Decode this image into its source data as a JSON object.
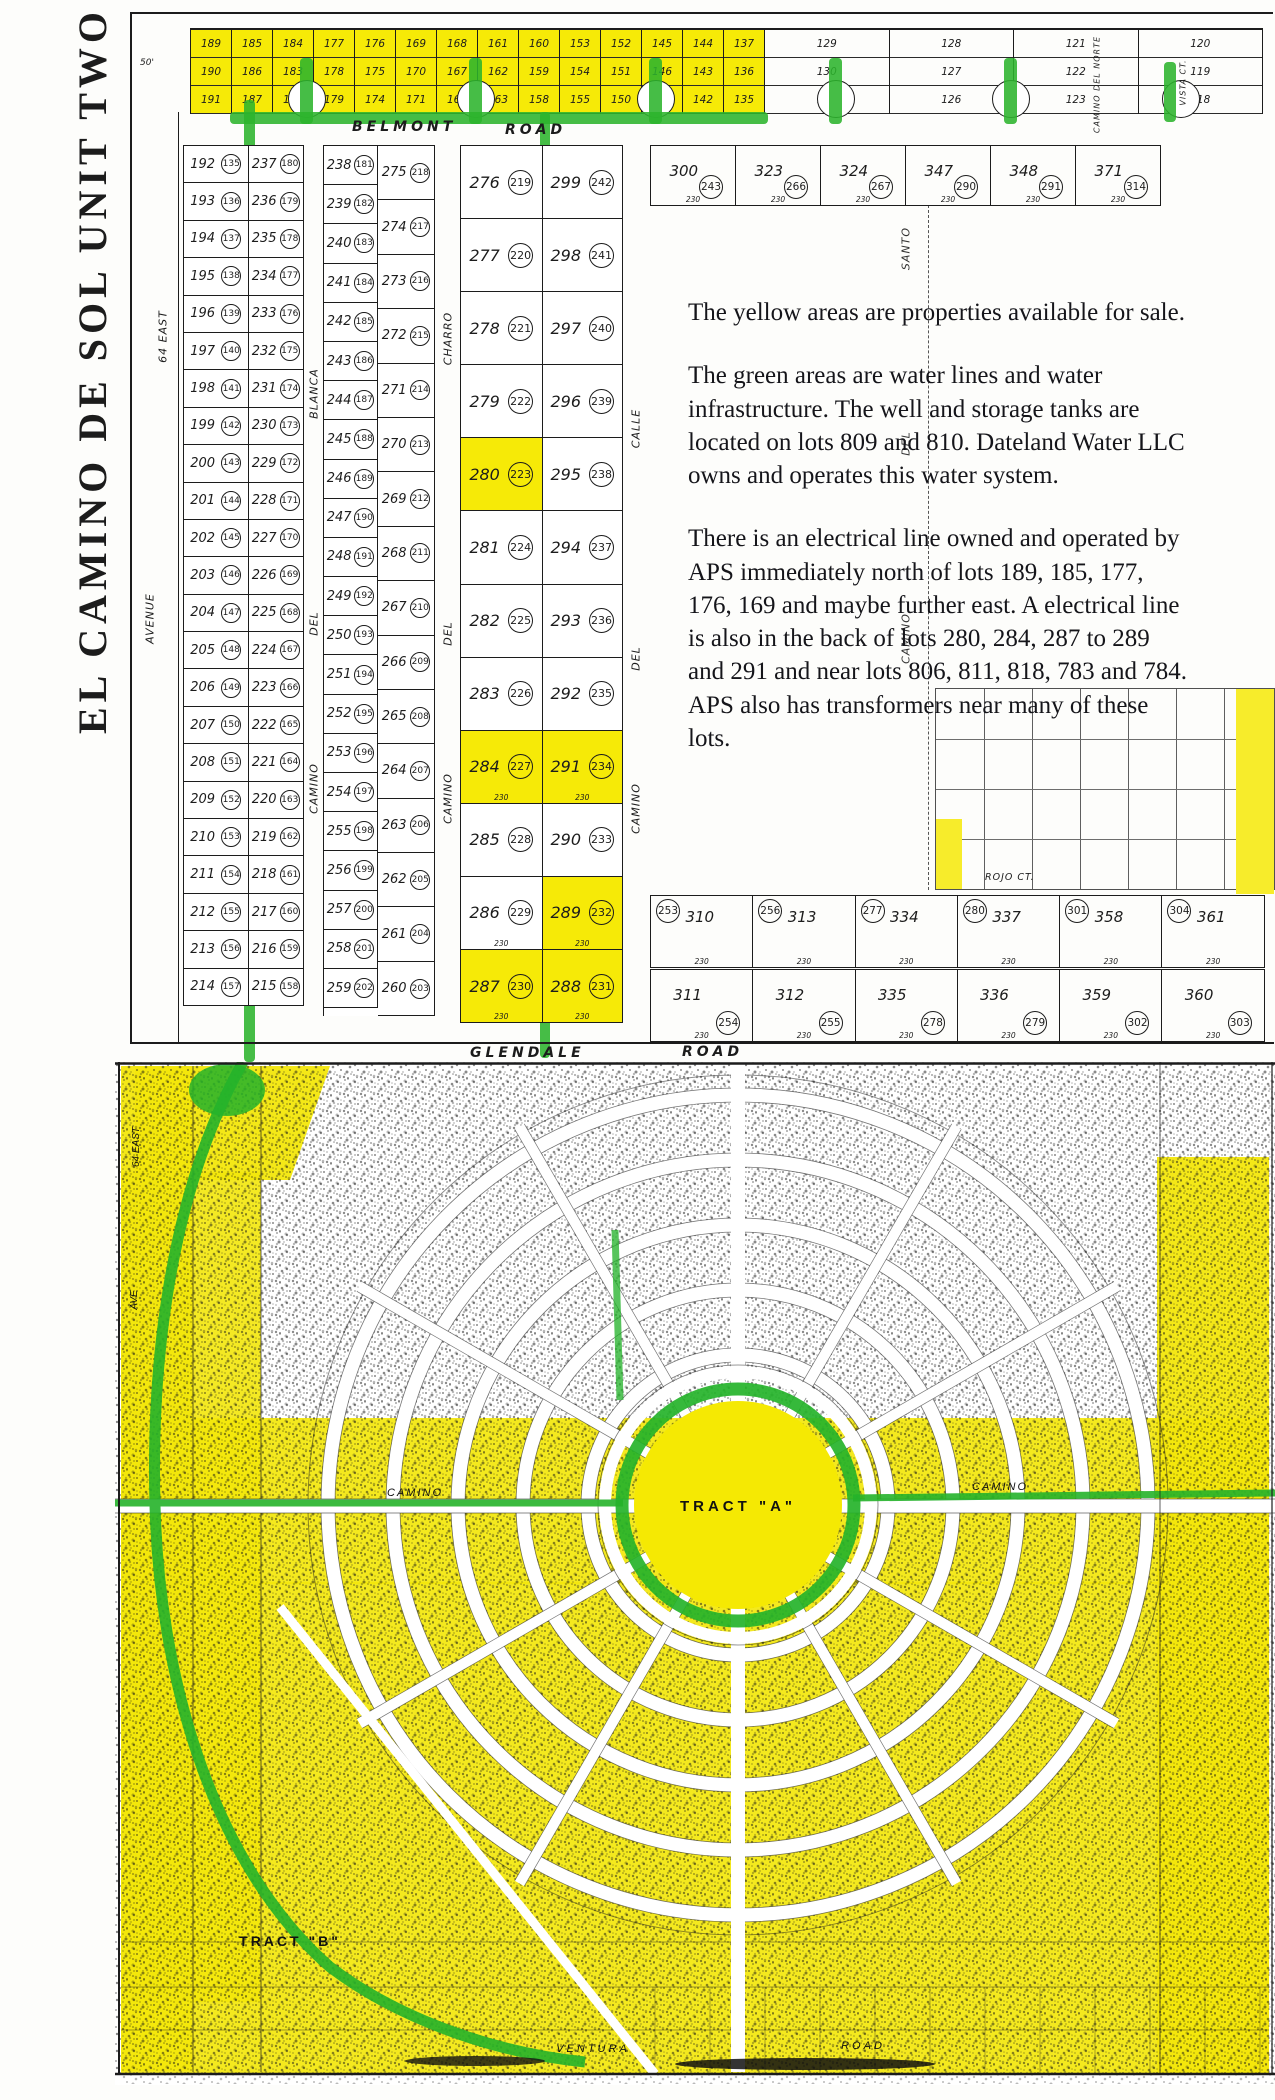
{
  "title": {
    "unit": "EL CAMINO DE SOL UNIT TWO"
  },
  "colors": {
    "highlight_yellow": "#f6ea07",
    "water_green": "#2cb42c",
    "ink": "#1c1c1c"
  },
  "roads": {
    "belmont_l": "BELMONT",
    "belmont_r": "ROAD",
    "glendale_l": "GLENDALE",
    "glendale_r": "ROAD",
    "ventura_l": "VENTURA",
    "ventura_r": "ROAD",
    "rojo_ct": "ROJO CT.",
    "vista_ct": "VISTA CT.",
    "norte": "CAMINO DEL NORTE",
    "camino_w": "CAMINO",
    "camino_e": "CAMINO"
  },
  "margins": {
    "fifty": "50'",
    "east64": "64 EAST",
    "avenue": "AVENUE",
    "east64_lower": "64 EAST",
    "ave_lower": "AVE"
  },
  "streets": {
    "s1": [
      "CAMINO",
      "DEL",
      "BLANCA"
    ],
    "s2": [
      "CAMINO",
      "DEL",
      "CHARRO"
    ],
    "s3": [
      "CAMINO",
      "DEL",
      "CALLE"
    ],
    "right": [
      "CAMINO",
      "DEL",
      "SANTO"
    ]
  },
  "annotation": {
    "p1": "The yellow areas are properties available for sale.",
    "p2": "The green areas are water lines and water infrastructure.   The well and storage tanks are located on lots 809 and 810.  Dateland Water LLC owns and operates this water system.",
    "p3": "There is an electrical line owned and operated by APS immediately north of lots 189, 185, 177, 176, 169 and maybe further east.  A electrical line is also in the back of lots 280, 284, 287 to 289 and 291 and near lots 806, 811, 818, 783 and 784.  APS also has transformers near many of these lots."
  },
  "top_strip": {
    "groups": [
      {
        "y": 1,
        "lots": [
          "189",
          "190",
          "191"
        ]
      },
      {
        "y": 1,
        "lots": [
          "185",
          "186",
          "187"
        ]
      },
      {
        "y": 1,
        "lots": [
          "184",
          "183",
          "182"
        ]
      },
      {
        "y": 1,
        "lots": [
          "177",
          "178",
          "179"
        ]
      },
      {
        "y": 1,
        "lots": [
          "176",
          "175",
          "174"
        ]
      },
      {
        "y": 1,
        "lots": [
          "169",
          "170",
          "171"
        ]
      },
      {
        "y": 1,
        "lots": [
          "168",
          "167",
          "166"
        ]
      },
      {
        "y": 1,
        "lots": [
          "161",
          "162",
          "163"
        ]
      },
      {
        "y": 1,
        "lots": [
          "160",
          "159",
          "158"
        ]
      },
      {
        "y": 1,
        "lots": [
          "153",
          "154",
          "155"
        ]
      },
      {
        "y": 1,
        "lots": [
          "152",
          "151",
          "150"
        ]
      },
      {
        "y": 1,
        "lots": [
          "145",
          "146",
          "147"
        ]
      },
      {
        "y": 1,
        "lots": [
          "144",
          "143",
          "142"
        ]
      },
      {
        "y": 1,
        "lots": [
          "137",
          "136",
          "135"
        ]
      },
      {
        "y": 0,
        "lots": [
          "129",
          "130",
          "131"
        ]
      },
      {
        "y": 0,
        "lots": [
          "128",
          "127",
          "126"
        ]
      },
      {
        "y": 0,
        "lots": [
          "121",
          "122",
          "123"
        ]
      },
      {
        "y": 0,
        "lots": [
          "120",
          "119",
          "118"
        ]
      }
    ]
  },
  "block1": {
    "rows": [
      [
        "192",
        "135",
        "237",
        "180"
      ],
      [
        "193",
        "136",
        "236",
        "179"
      ],
      [
        "194",
        "137",
        "235",
        "178"
      ],
      [
        "195",
        "138",
        "234",
        "177"
      ],
      [
        "196",
        "139",
        "233",
        "176"
      ],
      [
        "197",
        "140",
        "232",
        "175"
      ],
      [
        "198",
        "141",
        "231",
        "174"
      ],
      [
        "199",
        "142",
        "230",
        "173"
      ],
      [
        "200",
        "143",
        "229",
        "172"
      ],
      [
        "201",
        "144",
        "228",
        "171"
      ],
      [
        "202",
        "145",
        "227",
        "170"
      ],
      [
        "203",
        "146",
        "226",
        "169"
      ],
      [
        "204",
        "147",
        "225",
        "168"
      ],
      [
        "205",
        "148",
        "224",
        "167"
      ],
      [
        "206",
        "149",
        "223",
        "166"
      ],
      [
        "207",
        "150",
        "222",
        "165"
      ],
      [
        "208",
        "151",
        "221",
        "164"
      ],
      [
        "209",
        "152",
        "220",
        "163"
      ],
      [
        "210",
        "153",
        "219",
        "162"
      ],
      [
        "211",
        "154",
        "218",
        "161"
      ],
      [
        "212",
        "155",
        "217",
        "160"
      ],
      [
        "213",
        "156",
        "216",
        "159"
      ],
      [
        "214",
        "157",
        "215",
        "158"
      ]
    ]
  },
  "block2": {
    "left": [
      [
        "238",
        "181"
      ],
      [
        "239",
        "182"
      ],
      [
        "240",
        "183"
      ],
      [
        "241",
        "184"
      ],
      [
        "242",
        "185"
      ],
      [
        "243",
        "186"
      ],
      [
        "244",
        "187"
      ],
      [
        "245",
        "188"
      ],
      [
        "246",
        "189"
      ],
      [
        "247",
        "190"
      ],
      [
        "248",
        "191"
      ],
      [
        "249",
        "192"
      ],
      [
        "250",
        "193"
      ],
      [
        "251",
        "194"
      ],
      [
        "252",
        "195"
      ],
      [
        "253",
        "196"
      ],
      [
        "254",
        "197"
      ],
      [
        "255",
        "198"
      ],
      [
        "256",
        "199"
      ],
      [
        "257",
        "200"
      ],
      [
        "258",
        "201"
      ],
      [
        "259",
        "202"
      ]
    ],
    "right": [
      [
        "275",
        "218"
      ],
      [
        "274",
        "217"
      ],
      [
        "273",
        "216"
      ],
      [
        "272",
        "215"
      ],
      [
        "271",
        "214"
      ],
      [
        "270",
        "213"
      ],
      [
        "269",
        "212"
      ],
      [
        "268",
        "211"
      ],
      [
        "267",
        "210"
      ],
      [
        "266",
        "209"
      ],
      [
        "265",
        "208"
      ],
      [
        "264",
        "207"
      ],
      [
        "263",
        "206"
      ],
      [
        "262",
        "205"
      ],
      [
        "261",
        "204"
      ],
      [
        "260",
        "203"
      ]
    ]
  },
  "block3": {
    "rows": [
      {
        "l": "276",
        "lc": "219",
        "r": "299",
        "rc": "242",
        "ly": 0,
        "ry": 0
      },
      {
        "l": "277",
        "lc": "220",
        "r": "298",
        "rc": "241",
        "ly": 0,
        "ry": 0
      },
      {
        "l": "278",
        "lc": "221",
        "r": "297",
        "rc": "240",
        "ly": 0,
        "ry": 0
      },
      {
        "l": "279",
        "lc": "222",
        "r": "296",
        "rc": "239",
        "ly": 0,
        "ry": 0
      },
      {
        "l": "280",
        "lc": "223",
        "r": "295",
        "rc": "238",
        "ly": 1,
        "ry": 0
      },
      {
        "l": "281",
        "lc": "224",
        "r": "294",
        "rc": "237",
        "ly": 0,
        "ry": 0
      },
      {
        "l": "282",
        "lc": "225",
        "r": "293",
        "rc": "236",
        "ly": 0,
        "ry": 0
      },
      {
        "l": "283",
        "lc": "226",
        "r": "292",
        "rc": "235",
        "ly": 0,
        "ry": 0
      },
      {
        "l": "284",
        "lc": "227",
        "r": "291",
        "rc": "234",
        "ly": 1,
        "ry": 1,
        "dim": "230"
      },
      {
        "l": "285",
        "lc": "228",
        "r": "290",
        "rc": "233",
        "ly": 0,
        "ry": 0
      },
      {
        "l": "286",
        "lc": "229",
        "r": "289",
        "rc": "232",
        "ly": 0,
        "ry": 1,
        "dim": "230"
      },
      {
        "l": "287",
        "lc": "230",
        "r": "288",
        "rc": "231",
        "ly": 1,
        "ry": 1,
        "dim": "230"
      }
    ]
  },
  "right_top": {
    "cells": [
      {
        "lot": "300",
        "c": "243",
        "dim": "230"
      },
      {
        "lot": "323",
        "c": "266",
        "dim": "230"
      },
      {
        "lot": "324",
        "c": "267",
        "dim": "230"
      },
      {
        "lot": "347",
        "c": "290",
        "dim": "230"
      },
      {
        "lot": "348",
        "c": "291",
        "dim": "230"
      },
      {
        "lot": "371",
        "c": "314",
        "dim": "230"
      }
    ]
  },
  "right_bottom": {
    "row1": [
      {
        "lot": "310",
        "c": "253",
        "dim": "230"
      },
      {
        "lot": "313",
        "c": "256",
        "dim": "230"
      },
      {
        "lot": "334",
        "c": "277",
        "dim": "230"
      },
      {
        "lot": "337",
        "c": "280",
        "dim": "230"
      },
      {
        "lot": "358",
        "c": "301",
        "dim": "230"
      },
      {
        "lot": "361",
        "c": "304",
        "dim": "230"
      }
    ],
    "row2": [
      {
        "lot": "311",
        "c": "254",
        "dim": "230"
      },
      {
        "lot": "312",
        "c": "255",
        "dim": "230"
      },
      {
        "lot": "335",
        "c": "278",
        "dim": "230"
      },
      {
        "lot": "336",
        "c": "279",
        "dim": "230"
      },
      {
        "lot": "359",
        "c": "302",
        "dim": "230"
      },
      {
        "lot": "360",
        "c": "303",
        "dim": "230"
      }
    ]
  },
  "tracts": {
    "a": "TRACT  \"A\"",
    "b": "TRACT  \"B\""
  }
}
